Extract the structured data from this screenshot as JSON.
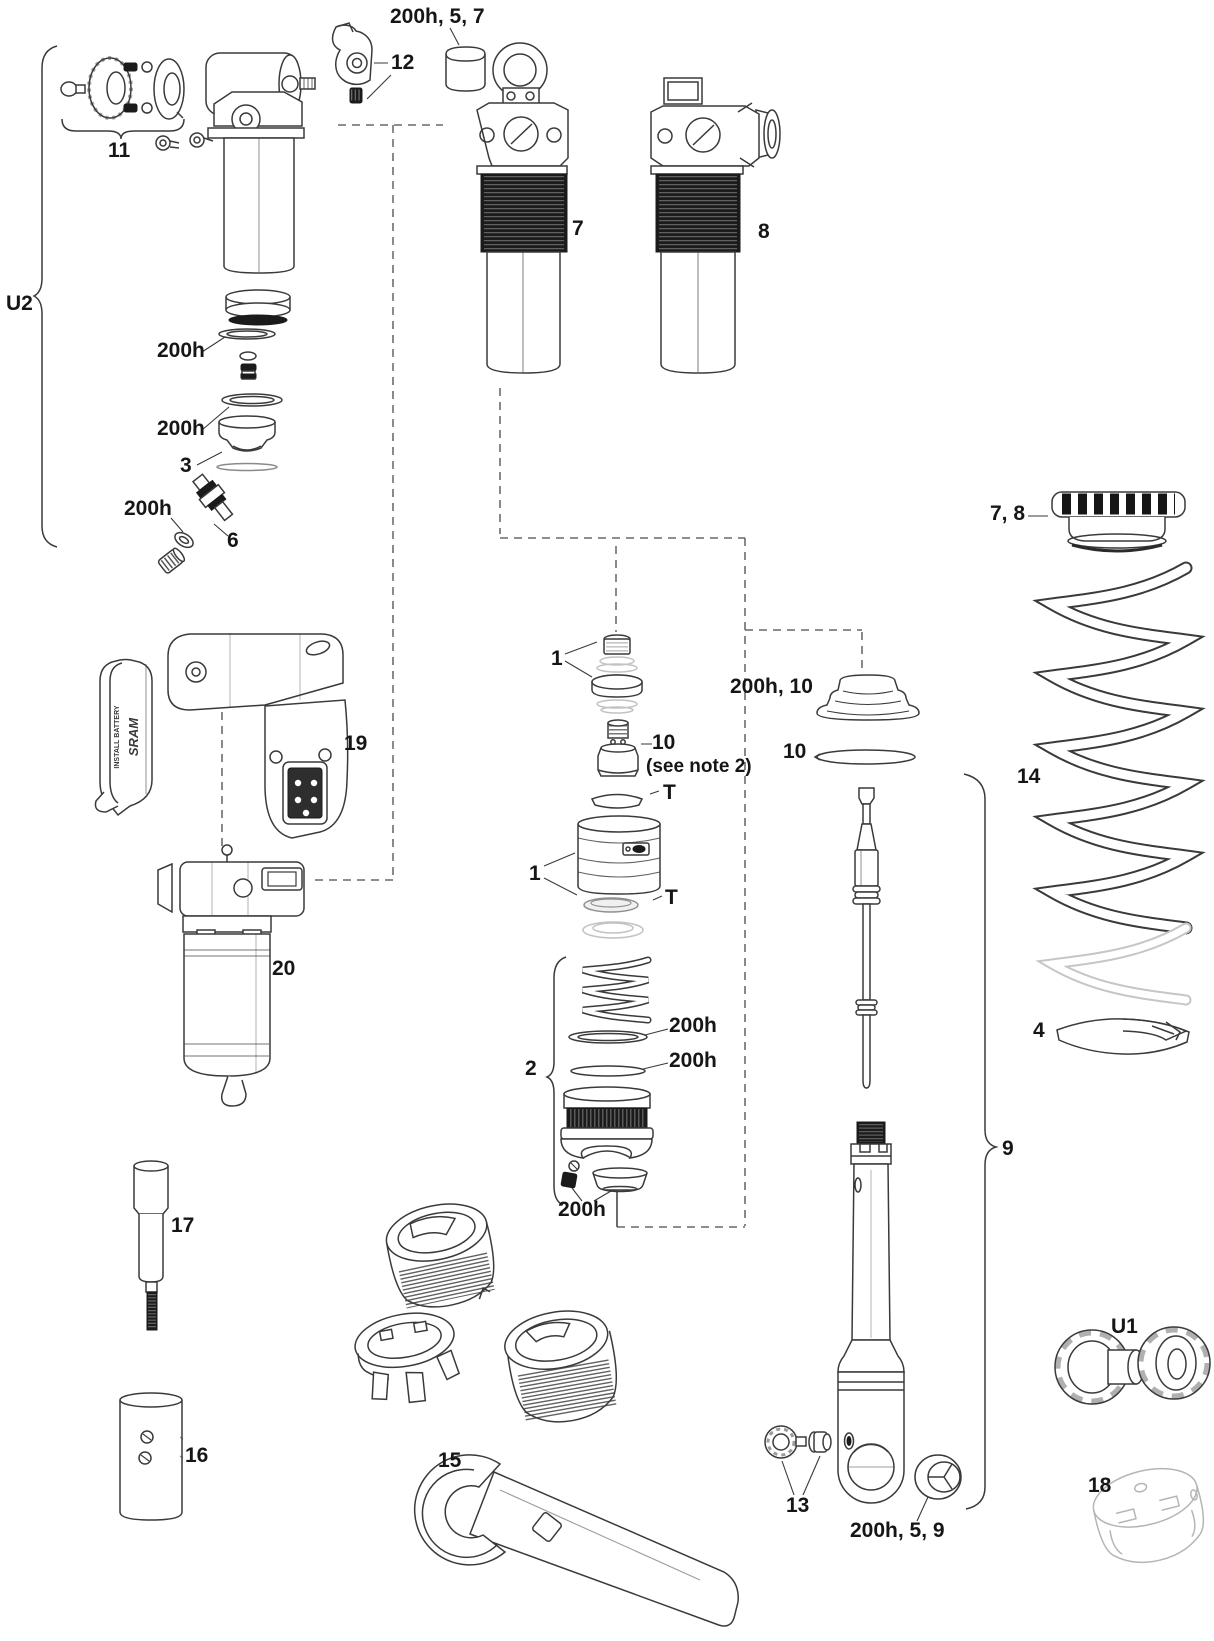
{
  "page": {
    "kind": "exploded parts diagram page",
    "background": "#ffffff",
    "line_color": "#3a3a3a",
    "dark_part_color": "#1b1b1b",
    "ghost_part_color": "#c2c2c2"
  },
  "callouts": {
    "bumper_top": {
      "text": "200h, 5, 7"
    },
    "lever12": {
      "text": "12"
    },
    "hardware11": {
      "text": "11"
    },
    "u2": {
      "text": "U2"
    },
    "seal_a": {
      "text": "200h"
    },
    "seal_b": {
      "text": "200h"
    },
    "piston3": {
      "text": "3"
    },
    "seal_c": {
      "text": "200h"
    },
    "valve6": {
      "text": "6"
    },
    "shock7": {
      "text": "7"
    },
    "shock8": {
      "text": "8"
    },
    "group1_top": {
      "text": "1"
    },
    "part10": {
      "text": "10"
    },
    "note2": {
      "text": "(see note 2)"
    },
    "t_top": {
      "text": "T"
    },
    "group1_bot": {
      "text": "1"
    },
    "t_bot": {
      "text": "T"
    },
    "bumper10": {
      "text": "200h, 10"
    },
    "washer10": {
      "text": "10"
    },
    "group2": {
      "text": "2"
    },
    "seal_d": {
      "text": "200h"
    },
    "seal_e": {
      "text": "200h"
    },
    "seal_f": {
      "text": "200h"
    },
    "module19": {
      "text": "19"
    },
    "assembly20": {
      "text": "20"
    },
    "tool17": {
      "text": "17"
    },
    "block16": {
      "text": "16"
    },
    "wrench15": {
      "text": "15"
    },
    "collar78": {
      "text": "7, 8"
    },
    "spring14": {
      "text": "14"
    },
    "seat4": {
      "text": "4"
    },
    "group9": {
      "text": "9"
    },
    "part13": {
      "text": "13"
    },
    "eyelet_hw": {
      "text": "200h, 5, 9"
    },
    "u1": {
      "text": "U1"
    },
    "socket18": {
      "text": "18"
    }
  },
  "battery_cover": {
    "brand": "SRAM",
    "warning": "INSTALL BATTERY"
  }
}
